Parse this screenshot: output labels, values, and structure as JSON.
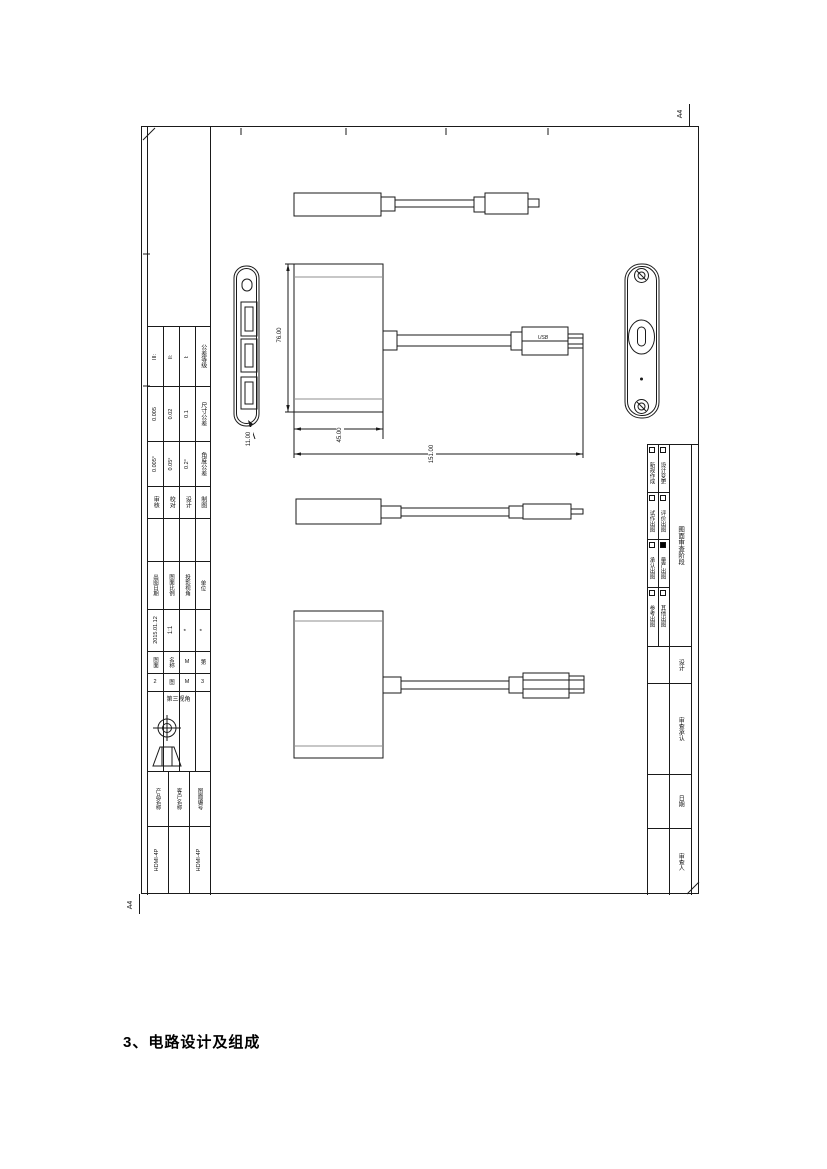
{
  "document": {
    "heading": "3、电路设计及组成"
  },
  "sheet": {
    "paper_size": "A4",
    "usb_logo": "USB",
    "dimensions": {
      "body_height": "76.00",
      "body_width": "45.00",
      "overall_length": "151.00",
      "body_thickness": "11.00"
    },
    "title_block": {
      "tolerance_rows": [
        {
          "label": "公差等级",
          "values": [
            "III:",
            "II:",
            "I:"
          ]
        },
        {
          "label": "尺寸公差",
          "values": [
            "0.005",
            "0.02",
            "0.1"
          ]
        },
        {
          "label": "角度公差",
          "values": [
            "0.005°",
            "0.05°",
            "0.2°"
          ]
        }
      ],
      "role_labels": [
        "审核",
        "校对",
        "设计",
        "制图"
      ],
      "meta_labels": [
        "出图日期",
        "图面比例",
        "投影视角",
        "单位"
      ],
      "meta_values": [
        "2015.01.12",
        "1:1",
        "*",
        "*"
      ],
      "meta_notes": [
        {
          "a": "图面",
          "b": "2"
        },
        {
          "a": "名称",
          "b": "图"
        },
        {
          "a": "M",
          "b": "M"
        },
        {
          "a": "第",
          "b": "3"
        }
      ],
      "projection_label": "第三视角",
      "product_labels": [
        "产品名称",
        "客户名称",
        "图面编号"
      ],
      "product_values": [
        "HDMI-4P",
        "",
        "HDMI-4P"
      ]
    },
    "review_panel": {
      "stage_header": "图面审查阶段",
      "checkboxes": [
        {
          "label": "新规作成",
          "checked": false
        },
        {
          "label": "设计变更",
          "checked": false
        },
        {
          "label": "试作出图",
          "checked": false
        },
        {
          "label": "评价出图",
          "checked": false
        },
        {
          "label": "承认出图",
          "checked": false
        },
        {
          "label": "量产出图",
          "checked": true
        },
        {
          "label": "参考出图",
          "checked": false
        },
        {
          "label": "其他出图",
          "checked": false
        }
      ],
      "sign_labels": [
        "设计",
        "审查承认",
        "日期",
        "审查人"
      ]
    }
  }
}
